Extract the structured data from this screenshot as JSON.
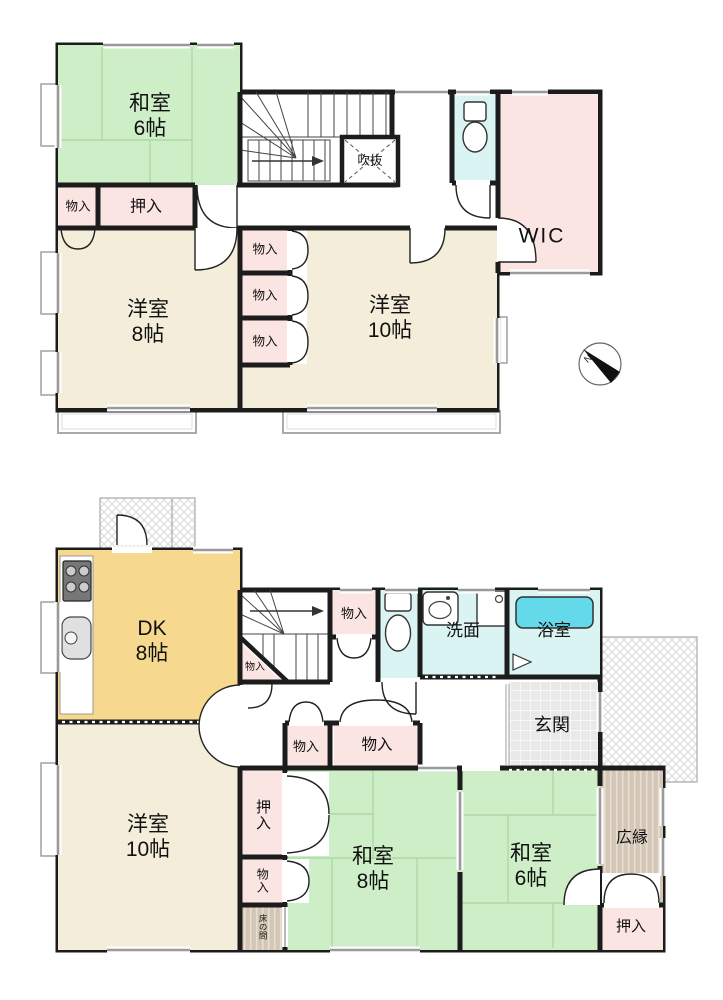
{
  "colors": {
    "wall": "#1c1c1c",
    "tatami": "#cdeec6",
    "wood": "#f3edd9",
    "dk": "#f6d98e",
    "closet": "#fbe5e3",
    "wet": "#daf3f3",
    "tub": "#63d9e9",
    "window": "#9a9a9a",
    "stripe_base": "#d4c6b5",
    "hatch": "#d9d9d9"
  },
  "compass": {
    "north_label": "N"
  },
  "floor2": {
    "washitsu6": {
      "name": "和室",
      "size": "6帖"
    },
    "monoire_corner": {
      "label": "物入"
    },
    "oshiire": {
      "label": "押入"
    },
    "yoshitsu8": {
      "name": "洋室",
      "size": "8帖"
    },
    "monoire_1": {
      "label": "物入"
    },
    "monoire_2": {
      "label": "物入"
    },
    "monoire_3": {
      "label": "物入"
    },
    "yoshitsu10": {
      "name": "洋室",
      "size": "10帖"
    },
    "fukinuke": {
      "label": "吹抜"
    },
    "wic": {
      "label": "WIC"
    }
  },
  "floor1": {
    "dk": {
      "name": "DK",
      "size": "8帖"
    },
    "monoire_understair": {
      "label": "物入"
    },
    "monoire_by_stair": {
      "label": "物入"
    },
    "senmen": {
      "label": "洗面"
    },
    "yokushitsu": {
      "label": "浴室"
    },
    "genkan": {
      "label": "玄関"
    },
    "monoire_hall_1": {
      "label": "物入"
    },
    "monoire_hall_2": {
      "label": "物入"
    },
    "yoshitsu10": {
      "name": "洋室",
      "size": "10帖"
    },
    "oshiire_side": {
      "label": "押入"
    },
    "monoire_side": {
      "label": "物入"
    },
    "tokonoma": {
      "label": "床の間"
    },
    "washitsu8": {
      "name": "和室",
      "size": "8帖"
    },
    "washitsu6": {
      "name": "和室",
      "size": "6帖"
    },
    "hiroen": {
      "label": "広縁"
    },
    "oshiire_veranda": {
      "label": "押入"
    }
  }
}
